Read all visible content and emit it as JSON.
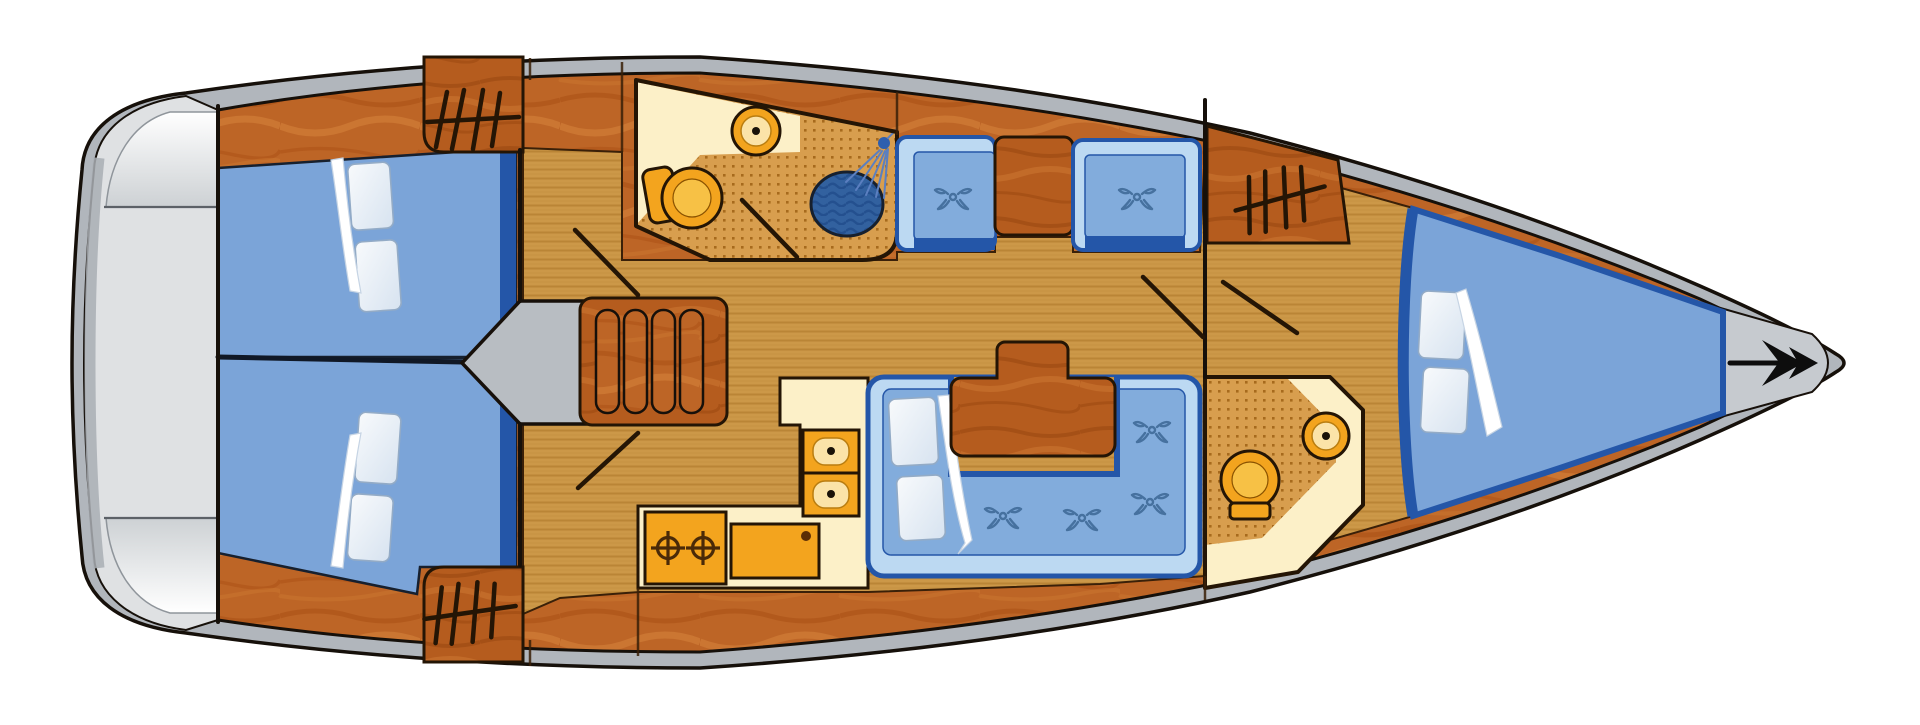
{
  "diagram": {
    "type": "sailing-yacht-interior-floor-plan",
    "orientation": "bow-right-stern-left",
    "rooms": [
      {
        "id": "swim-platform",
        "position": "stern",
        "features": [
          "transom-platform",
          "fold-lines"
        ]
      },
      {
        "id": "aft-cabin-port",
        "position": "stern-top",
        "features": [
          "double-berth",
          "2-pillows",
          "blanket",
          "hanging-locker",
          "door"
        ]
      },
      {
        "id": "aft-cabin-starboard",
        "position": "stern-bottom",
        "features": [
          "double-berth",
          "2-pillows",
          "blanket",
          "hanging-locker",
          "door"
        ]
      },
      {
        "id": "companionway",
        "position": "midship-left",
        "features": [
          "engine-compartment",
          "companionway-steps"
        ]
      },
      {
        "id": "aft-head",
        "position": "midship-top",
        "features": [
          "toilet",
          "washbasin",
          "shower-basin",
          "shower-head",
          "wet-floor",
          "door"
        ]
      },
      {
        "id": "galley",
        "position": "midship-bottom",
        "features": [
          "twin-sinks",
          "two-burner-stove",
          "refrigerator",
          "counter"
        ]
      },
      {
        "id": "salon",
        "position": "midship",
        "features": [
          "two-single-seats",
          "cabinet-block",
          "u-shaped-settee",
          "2-pillows",
          "saloon-table"
        ]
      },
      {
        "id": "forward-head",
        "position": "forward-bottom",
        "features": [
          "toilet",
          "washbasin",
          "wet-floor",
          "door"
        ]
      },
      {
        "id": "forward-cabin",
        "position": "bow",
        "features": [
          "v-berth",
          "2-pillows",
          "blanket",
          "hanging-locker",
          "door"
        ]
      },
      {
        "id": "bow-deck",
        "position": "bow-tip",
        "features": [
          "anchor"
        ]
      }
    ]
  },
  "icons": [
    {
      "name": "hanging-locker-icon",
      "meaning": "wardrobe / hanging clothes rail",
      "count": 3
    },
    {
      "name": "cushion-swirl-icon",
      "meaning": "upholstery button",
      "count": 6
    },
    {
      "name": "burner-icon",
      "meaning": "stove burner",
      "count": 2
    },
    {
      "name": "shower-head-icon",
      "meaning": "shower spray",
      "count": 1
    },
    {
      "name": "anchor-icon",
      "meaning": "bow anchor",
      "count": 1
    }
  ],
  "colors": {
    "hull-band": "#b1b6bc",
    "hull-stroke": "#16100a",
    "platform-mid": "#dfe1e3",
    "platform-shadow": "#a9aeb4",
    "wood-base": "#bd6526",
    "floor-base": "#cc9848",
    "dotted-base": "#d89e4e",
    "cream": "#fcf0c8",
    "bed-blue": "#7ba4d8",
    "bed-edge": "#2456a8",
    "seat-back": "#bcd9f2",
    "cushion-blue": "#82acdc",
    "swirl-blue": "#46719f",
    "orange": "#f3a41e",
    "orange-light": "#f7c145",
    "orange-pale": "#fbe3a8",
    "shower-blue": "#32619f",
    "line-dark": "#241505",
    "anchor-black": "#0d0d0d"
  }
}
